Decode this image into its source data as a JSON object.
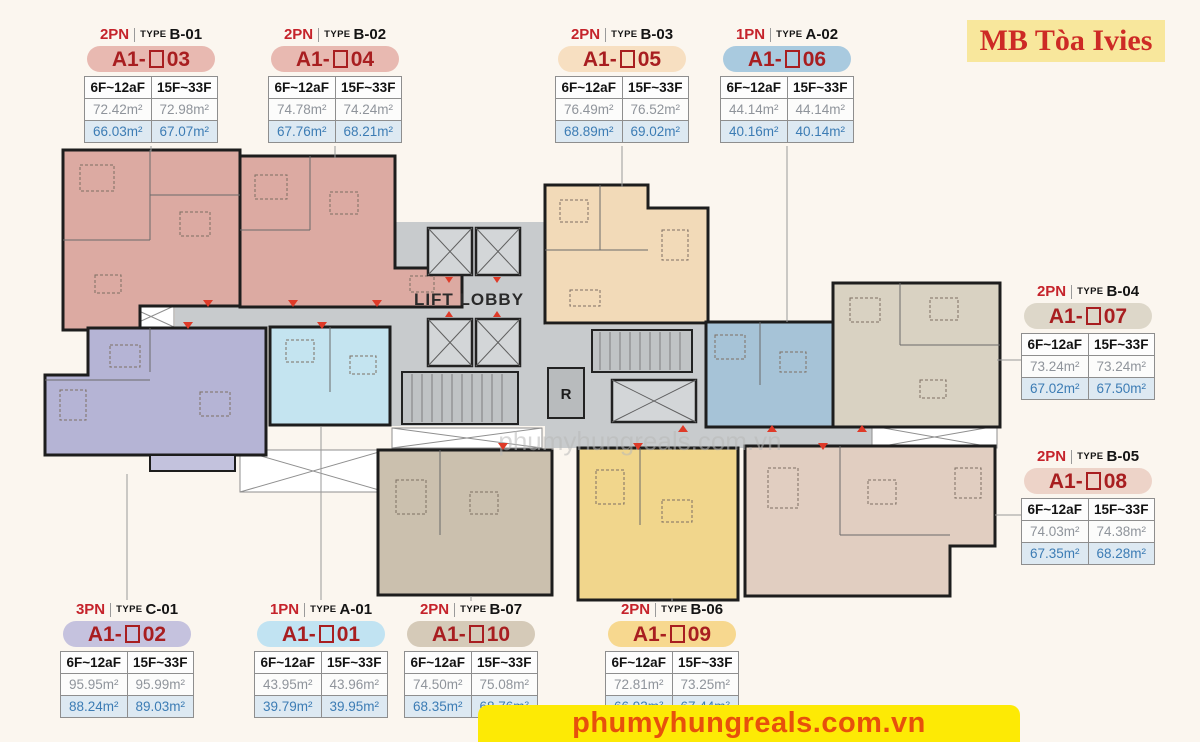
{
  "title_box": {
    "text": "MB Tòa Ivies",
    "bg": "#f8e79c",
    "color": "#cd2a25"
  },
  "footer_banner": {
    "text": "phumyhungreals.com.vn",
    "bg": "#fdea05",
    "color": "#e7500c"
  },
  "plan": {
    "lift_lobby_label": "LIFT LOBBY",
    "r_label": "R",
    "watermark": "phumyhungreals.com.vn",
    "corridor_color": "#c8cbcd",
    "wall_color": "#1d1d1d",
    "arrow_color": "#df3a28"
  },
  "units": [
    {
      "id": "A1-03",
      "bedrooms": "2PN",
      "type_word": "TYPE",
      "type_code": "B-01",
      "name_prefix": "A1-",
      "name_number": "03",
      "pill_color": "#e8b9b1",
      "unit_color": "#dcaaa2",
      "floors": [
        "6F~12aF",
        "15F~33F"
      ],
      "area_upper": [
        "72.42m²",
        "72.98m²"
      ],
      "area_lower": [
        "66.03m²",
        "67.07m²"
      ]
    },
    {
      "id": "A1-04",
      "bedrooms": "2PN",
      "type_word": "TYPE",
      "type_code": "B-02",
      "name_prefix": "A1-",
      "name_number": "04",
      "pill_color": "#e8b9b1",
      "unit_color": "#dcaaa2",
      "floors": [
        "6F~12aF",
        "15F~33F"
      ],
      "area_upper": [
        "74.78m²",
        "74.24m²"
      ],
      "area_lower": [
        "67.76m²",
        "68.21m²"
      ]
    },
    {
      "id": "A1-05",
      "bedrooms": "2PN",
      "type_word": "TYPE",
      "type_code": "B-03",
      "name_prefix": "A1-",
      "name_number": "05",
      "pill_color": "#f7dfc1",
      "unit_color": "#f2dab8",
      "floors": [
        "6F~12aF",
        "15F~33F"
      ],
      "area_upper": [
        "76.49m²",
        "76.52m²"
      ],
      "area_lower": [
        "68.89m²",
        "69.02m²"
      ]
    },
    {
      "id": "A1-06",
      "bedrooms": "1PN",
      "type_word": "TYPE",
      "type_code": "A-02",
      "name_prefix": "A1-",
      "name_number": "06",
      "pill_color": "#a9cadf",
      "unit_color": "#a6c3d7",
      "floors": [
        "6F~12aF",
        "15F~33F"
      ],
      "area_upper": [
        "44.14m²",
        "44.14m²"
      ],
      "area_lower": [
        "40.16m²",
        "40.14m²"
      ]
    },
    {
      "id": "A1-07",
      "bedrooms": "2PN",
      "type_word": "TYPE",
      "type_code": "B-04",
      "name_prefix": "A1-",
      "name_number": "07",
      "pill_color": "#ddd7c9",
      "unit_color": "#d9d2c2",
      "floors": [
        "6F~12aF",
        "15F~33F"
      ],
      "area_upper": [
        "73.24m²",
        "73.24m²"
      ],
      "area_lower": [
        "67.02m²",
        "67.50m²"
      ]
    },
    {
      "id": "A1-08",
      "bedrooms": "2PN",
      "type_word": "TYPE",
      "type_code": "B-05",
      "name_prefix": "A1-",
      "name_number": "08",
      "pill_color": "#edd3c8",
      "unit_color": "#e1cec1",
      "floors": [
        "6F~12aF",
        "15F~33F"
      ],
      "area_upper": [
        "74.03m²",
        "74.38m²"
      ],
      "area_lower": [
        "67.35m²",
        "68.28m²"
      ]
    },
    {
      "id": "A1-02",
      "bedrooms": "3PN",
      "type_word": "TYPE",
      "type_code": "C-01",
      "name_prefix": "A1-",
      "name_number": "02",
      "pill_color": "#c5c2de",
      "unit_color": "#b5b4d5",
      "floors": [
        "6F~12aF",
        "15F~33F"
      ],
      "area_upper": [
        "95.95m²",
        "95.99m²"
      ],
      "area_lower": [
        "88.24m²",
        "89.03m²"
      ]
    },
    {
      "id": "A1-01",
      "bedrooms": "1PN",
      "type_word": "TYPE",
      "type_code": "A-01",
      "name_prefix": "A1-",
      "name_number": "01",
      "pill_color": "#c1e3f2",
      "unit_color": "#c4e4f0",
      "floors": [
        "6F~12aF",
        "15F~33F"
      ],
      "area_upper": [
        "43.95m²",
        "43.96m²"
      ],
      "area_lower": [
        "39.79m²",
        "39.95m²"
      ]
    },
    {
      "id": "A1-10",
      "bedrooms": "2PN",
      "type_word": "TYPE",
      "type_code": "B-07",
      "name_prefix": "A1-",
      "name_number": "10",
      "pill_color": "#d5cab8",
      "unit_color": "#cbc0ae",
      "floors": [
        "6F~12aF",
        "15F~33F"
      ],
      "area_upper": [
        "74.50m²",
        "75.08m²"
      ],
      "area_lower": [
        "68.35m²",
        "68.76m²"
      ]
    },
    {
      "id": "A1-09",
      "bedrooms": "2PN",
      "type_word": "TYPE",
      "type_code": "B-06",
      "name_prefix": "A1-",
      "name_number": "09",
      "pill_color": "#f7d88f",
      "unit_color": "#f1d68c",
      "floors": [
        "6F~12aF",
        "15F~33F"
      ],
      "area_upper": [
        "72.81m²",
        "73.25m²"
      ],
      "area_lower": [
        "66.93m²",
        "67.44m²"
      ]
    }
  ]
}
